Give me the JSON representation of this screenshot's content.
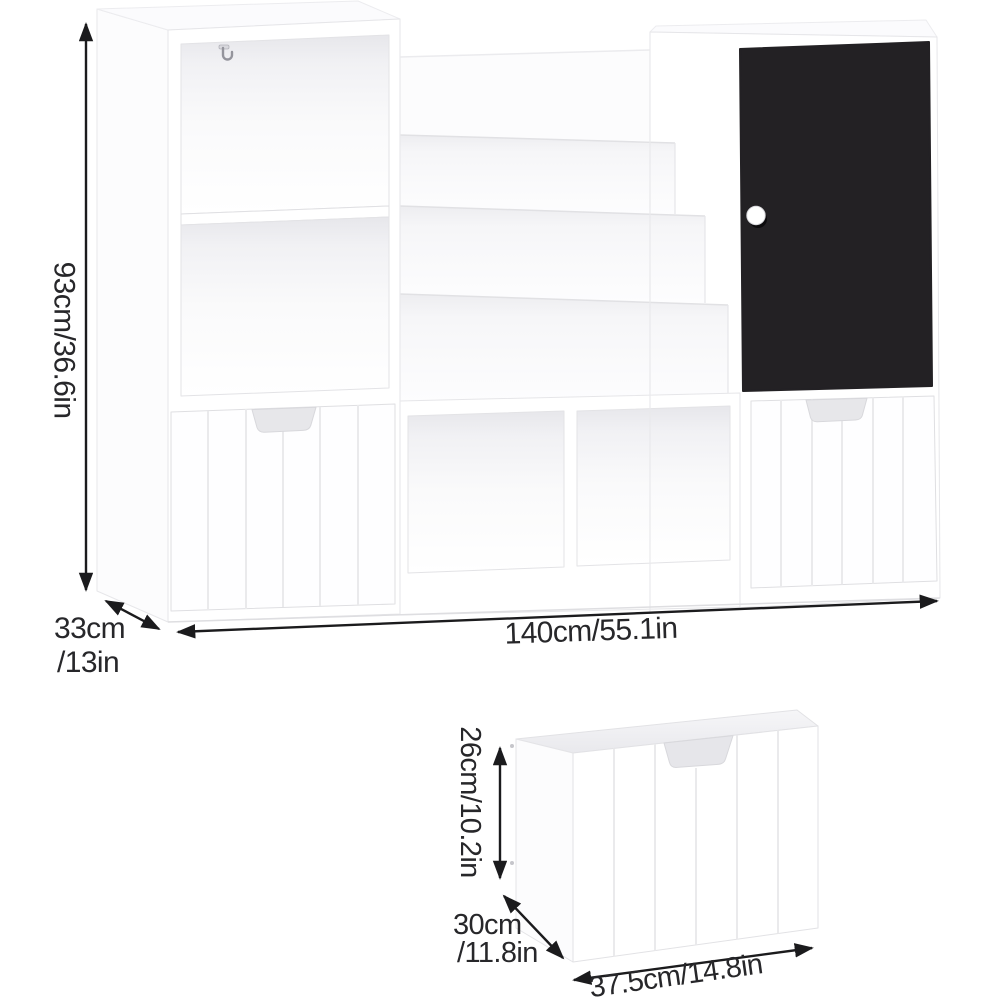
{
  "diagram": {
    "kind": "product-dimension-diagram",
    "product": "Kids bookshelf storage cabinet with open cubbies, tiered book rack, chalkboard door and pull-out drawers",
    "background": "#ffffff",
    "main_unit": {
      "height_label": "93cm/36.6in",
      "depth_label_line1": "33cm",
      "depth_label_line2": "/13in",
      "width_label": "140cm/55.1in"
    },
    "drawer_detail": {
      "height_label": "26cm/10.2in",
      "depth_label_line1": "30cm",
      "depth_label_line2": "/11.8in",
      "width_label": "37.5cm/14.8in"
    },
    "measurements": {
      "main_unit": {
        "width_cm": 140,
        "width_in": 55.1,
        "height_cm": 93,
        "height_in": 36.6,
        "depth_cm": 33,
        "depth_in": 13
      },
      "drawer": {
        "width_cm": 37.5,
        "width_in": 14.8,
        "height_cm": 26,
        "height_in": 10.2,
        "depth_cm": 30,
        "depth_in": 11.8
      }
    },
    "colors": {
      "chalkboard_door": "#232124",
      "dimension_lines": "#1b1b1d",
      "label_text": "#27272a",
      "furniture_edge": "#e4e4e7"
    },
    "icons": [
      {
        "name": "double-arrow-vertical",
        "meaning": "height dimension"
      },
      {
        "name": "double-arrow-diagonal",
        "meaning": "depth dimension"
      },
      {
        "name": "double-arrow-horizontal",
        "meaning": "width dimension"
      },
      {
        "name": "wall-hook",
        "meaning": "metal hook inside top cubby"
      },
      {
        "name": "door-knob",
        "meaning": "round white knob on chalkboard door"
      }
    ]
  }
}
